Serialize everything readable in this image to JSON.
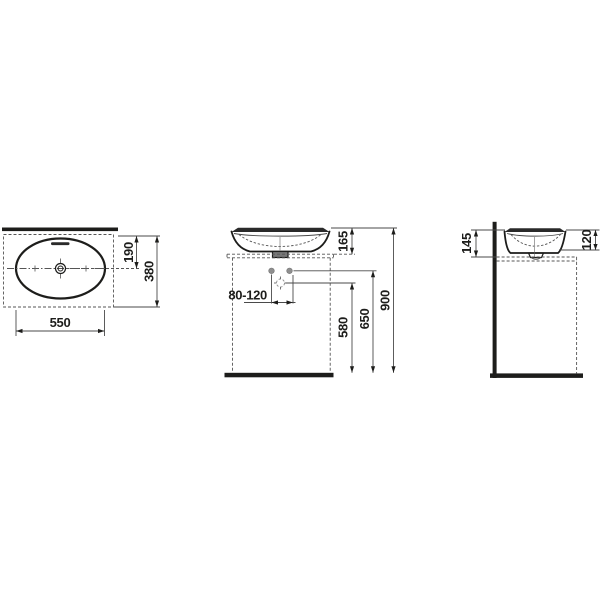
{
  "drawing": {
    "kind": "washbasin-dimension-drawing",
    "colors": {
      "background": "#ffffff",
      "line": "#1d1d1b",
      "thin_line": "#4a4a4a",
      "gray_marker": "#8f8f8f"
    }
  },
  "top_view": {
    "dims": {
      "drain_center_from_rear": "190",
      "depth": "380",
      "width": "550"
    }
  },
  "front_view": {
    "dims": {
      "basin_height": "165",
      "drain_offset_range": "80-120",
      "drain_height": "580",
      "supply_height": "650",
      "overall_height": "900"
    }
  },
  "side_view": {
    "dims": {
      "rim_above_counter": "145",
      "bowl_depth": "120"
    }
  }
}
